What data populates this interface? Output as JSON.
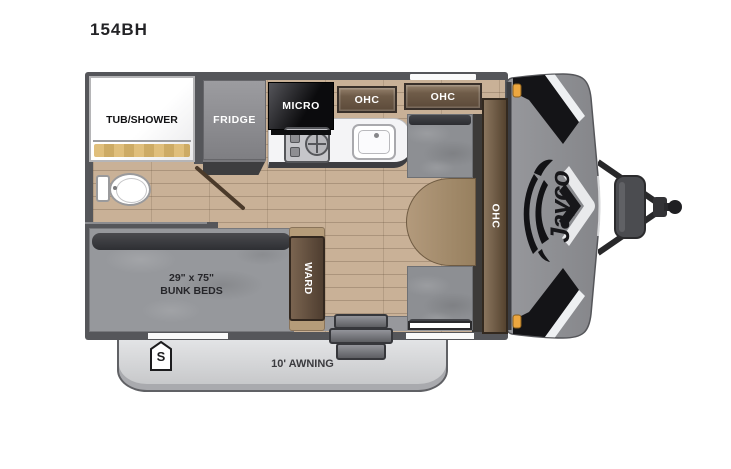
{
  "page": {
    "title": "154BH"
  },
  "brand": {
    "logo_text": "Jayco"
  },
  "floorplan": {
    "bathroom": {
      "tub_label": "TUB/SHOWER"
    },
    "kitchen": {
      "fridge_label": "FRIDGE",
      "micro_label": "MICRO",
      "ohc_left_label": "OHC",
      "ohc_right_label": "OHC"
    },
    "dinette": {
      "ohc_front_label": "OHC"
    },
    "bunk_room": {
      "size_label": "29\" x 75\"",
      "type_label": "BUNK BEDS",
      "wardrobe_label": "WARD"
    },
    "exterior": {
      "awning_label": "10' AWNING",
      "spare_badge_label": "S"
    }
  },
  "colors": {
    "wall": "#55565a",
    "floor_light": "#c9b197",
    "floor_dark": "#ab947c",
    "cabinet_wood": "#6f5c49",
    "cushion_gray": "#8d8f93",
    "front_cap_gray": "#8f9094",
    "chevron_black": "#141417",
    "marker_light_amber": "#eda73f",
    "awning_gray": "#d6d7d9",
    "tub_curtain_tan": "#d8b873"
  }
}
